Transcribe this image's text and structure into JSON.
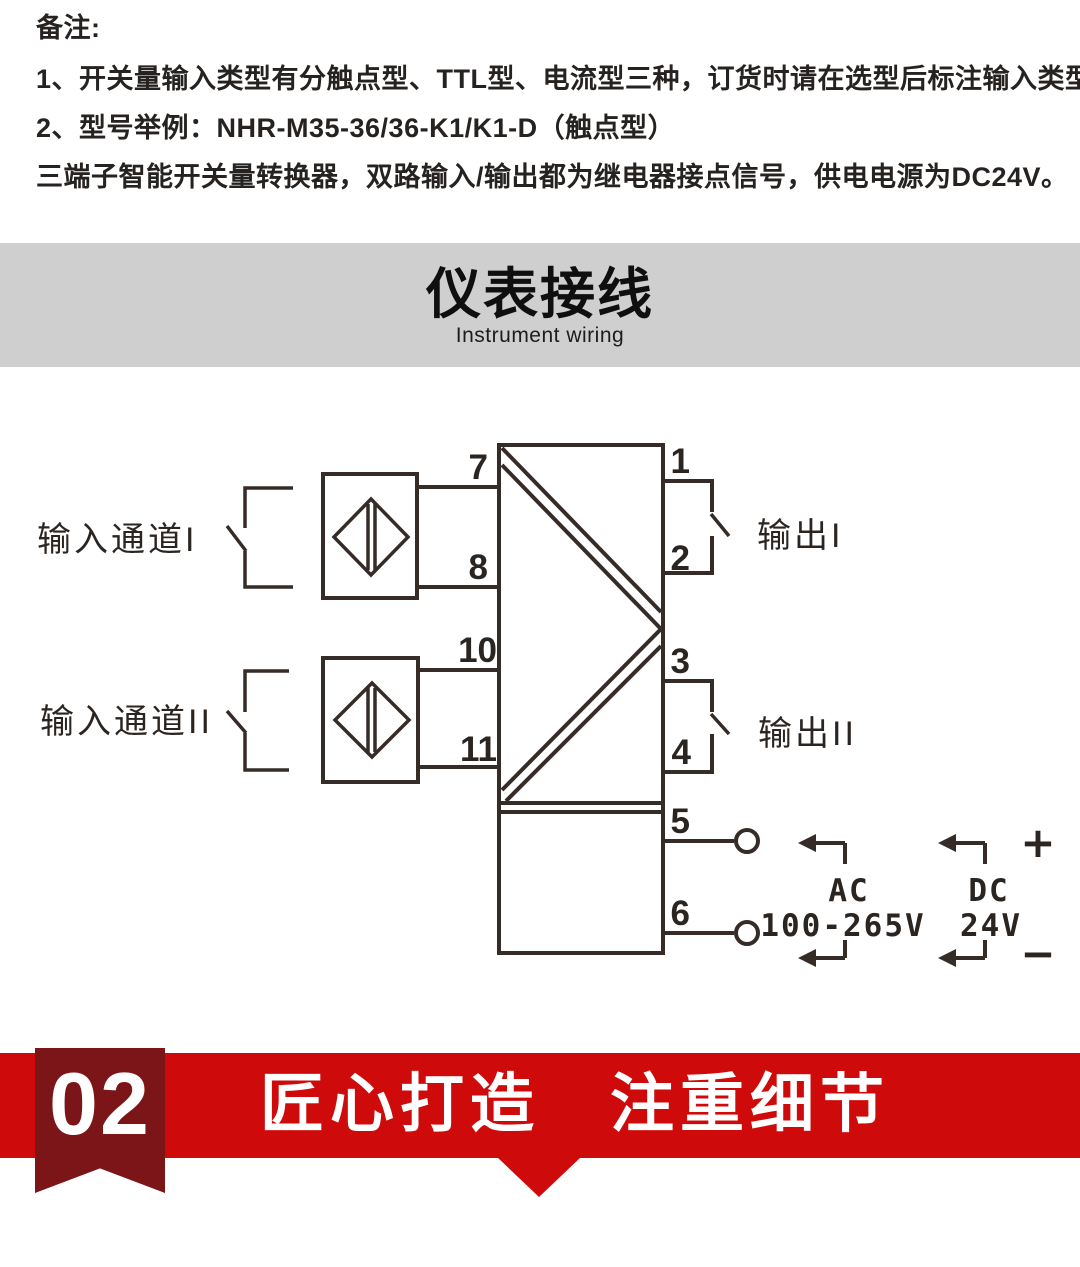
{
  "notes": {
    "heading": "备注:",
    "line1": "1、开关量输入类型有分触点型、TTL型、电流型三种，订货时请在选型后标注输入类型。",
    "line2": "2、型号举例：NHR-M35-36/36-K1/K1-D（触点型）",
    "line3": "三端子智能开关量转换器，双路输入/输出都为继电器接点信号，供电电源为DC24V。"
  },
  "section_banner": {
    "title": "仪表接线",
    "subtitle": "Instrument wiring",
    "background": "#d0cfcf"
  },
  "diagram": {
    "labels": {
      "input_channel_1": "输入通道I",
      "input_channel_2": "输入通道II",
      "output_1": "输出I",
      "output_2": "输出II"
    },
    "terminals": {
      "t1": "1",
      "t2": "2",
      "t3": "3",
      "t4": "4",
      "t5": "5",
      "t6": "6",
      "t7": "7",
      "t8": "8",
      "t10": "10",
      "t11": "11"
    },
    "power": {
      "ac": "AC",
      "ac_range": "100-265V",
      "dc": "DC",
      "dc_value": "24V",
      "plus": "+",
      "minus": "−"
    },
    "line_color": "#352b27"
  },
  "footer_banner": {
    "number": "02",
    "title": "匠心打造　注重细节",
    "red": "#cf0a0a",
    "dark_red": "#7b1517"
  }
}
